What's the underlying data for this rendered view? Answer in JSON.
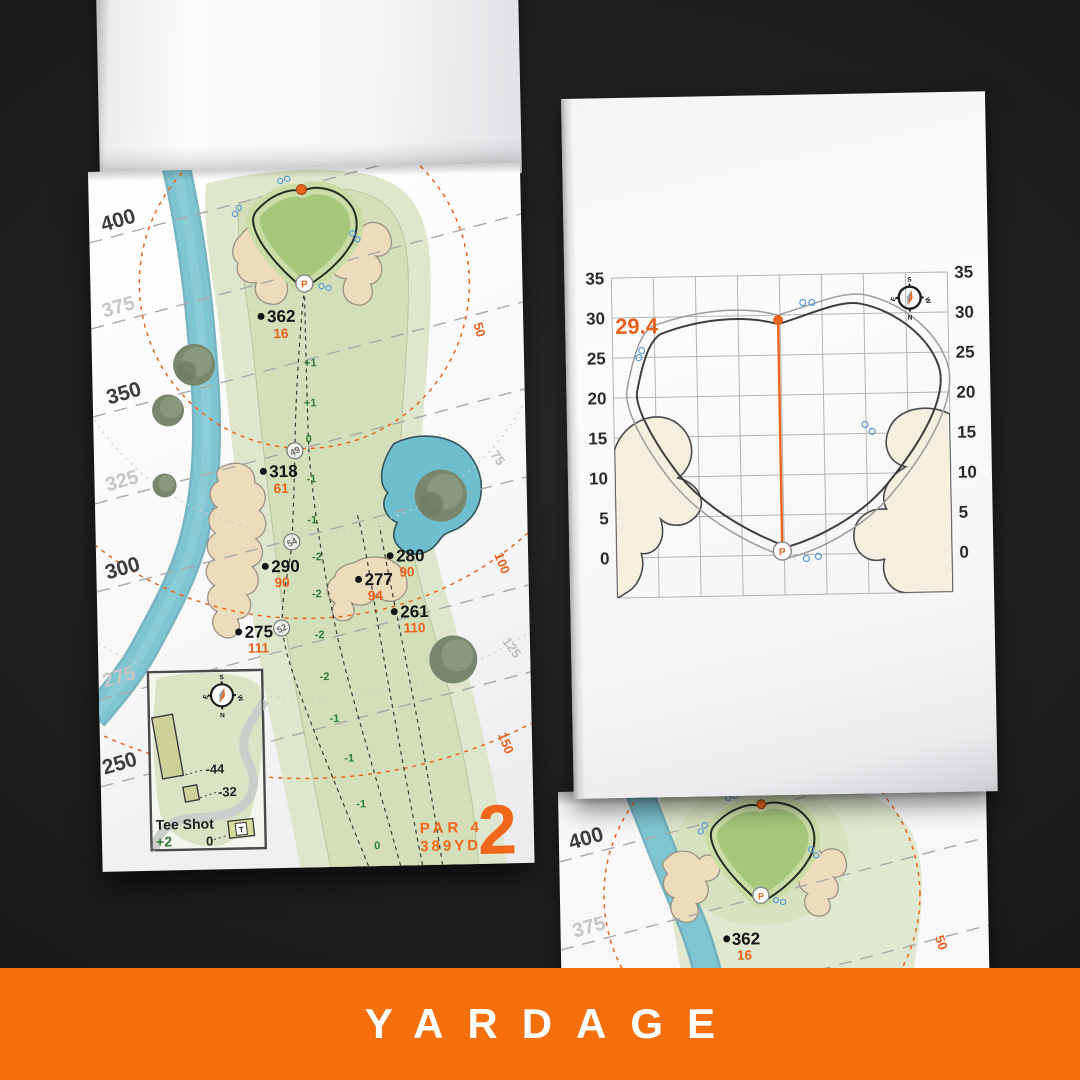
{
  "banner": {
    "title": "YARDAGE"
  },
  "compass_points": {
    "n": "N",
    "s": "S",
    "e": "E",
    "w": "W"
  },
  "left_page": {
    "distance_labels": [
      {
        "text": "400"
      },
      {
        "text": "375"
      },
      {
        "text": "350"
      },
      {
        "text": "325"
      },
      {
        "text": "300"
      },
      {
        "text": "275"
      },
      {
        "text": "250"
      }
    ],
    "arc_labels": [
      {
        "text": "50"
      },
      {
        "text": "75"
      },
      {
        "text": "100"
      },
      {
        "text": "125"
      },
      {
        "text": "150"
      }
    ],
    "markers": [
      {
        "yards": "362",
        "to_pin": "16"
      },
      {
        "yards": "318",
        "to_pin": "61"
      },
      {
        "yards": "290",
        "to_pin": "90"
      },
      {
        "yards": "280",
        "to_pin": "90"
      },
      {
        "yards": "277",
        "to_pin": "94"
      },
      {
        "yards": "261",
        "to_pin": "110"
      },
      {
        "yards": "275",
        "to_pin": "111"
      }
    ],
    "slope_values": [
      "+1",
      "+1",
      "0",
      "-1",
      "-1",
      "-2",
      "-2",
      "-2",
      "-2",
      "-1",
      "-1",
      "-1",
      "0"
    ],
    "node_values": [
      "49",
      "54",
      "52"
    ],
    "inset": {
      "title": "Tee Shot",
      "score": "+2",
      "offsets": [
        "-44",
        "-32",
        "0"
      ],
      "tee_label": "T"
    },
    "hole": {
      "par": "PAR 4",
      "yardage": "389YD",
      "number": "2"
    }
  },
  "right_page": {
    "measurement": "29.4",
    "axis_labels": [
      "35",
      "30",
      "25",
      "20",
      "15",
      "10",
      "5",
      "0"
    ]
  },
  "under_page": {
    "distance_labels": [
      "400",
      "375"
    ],
    "arc_label": "50",
    "marker": {
      "yards": "362",
      "to_pin": "16"
    }
  },
  "colors": {
    "banner_orange": "#F5700D",
    "accent_orange": "#E8661C",
    "putting_green": "#A6C77C",
    "fairway": "#D3DFB8",
    "rough": "#DEE7CB",
    "sand": "#EDDCBB",
    "water": "#7CC3D0",
    "slope_text": "#2E7D36",
    "tree": "#77876D"
  }
}
